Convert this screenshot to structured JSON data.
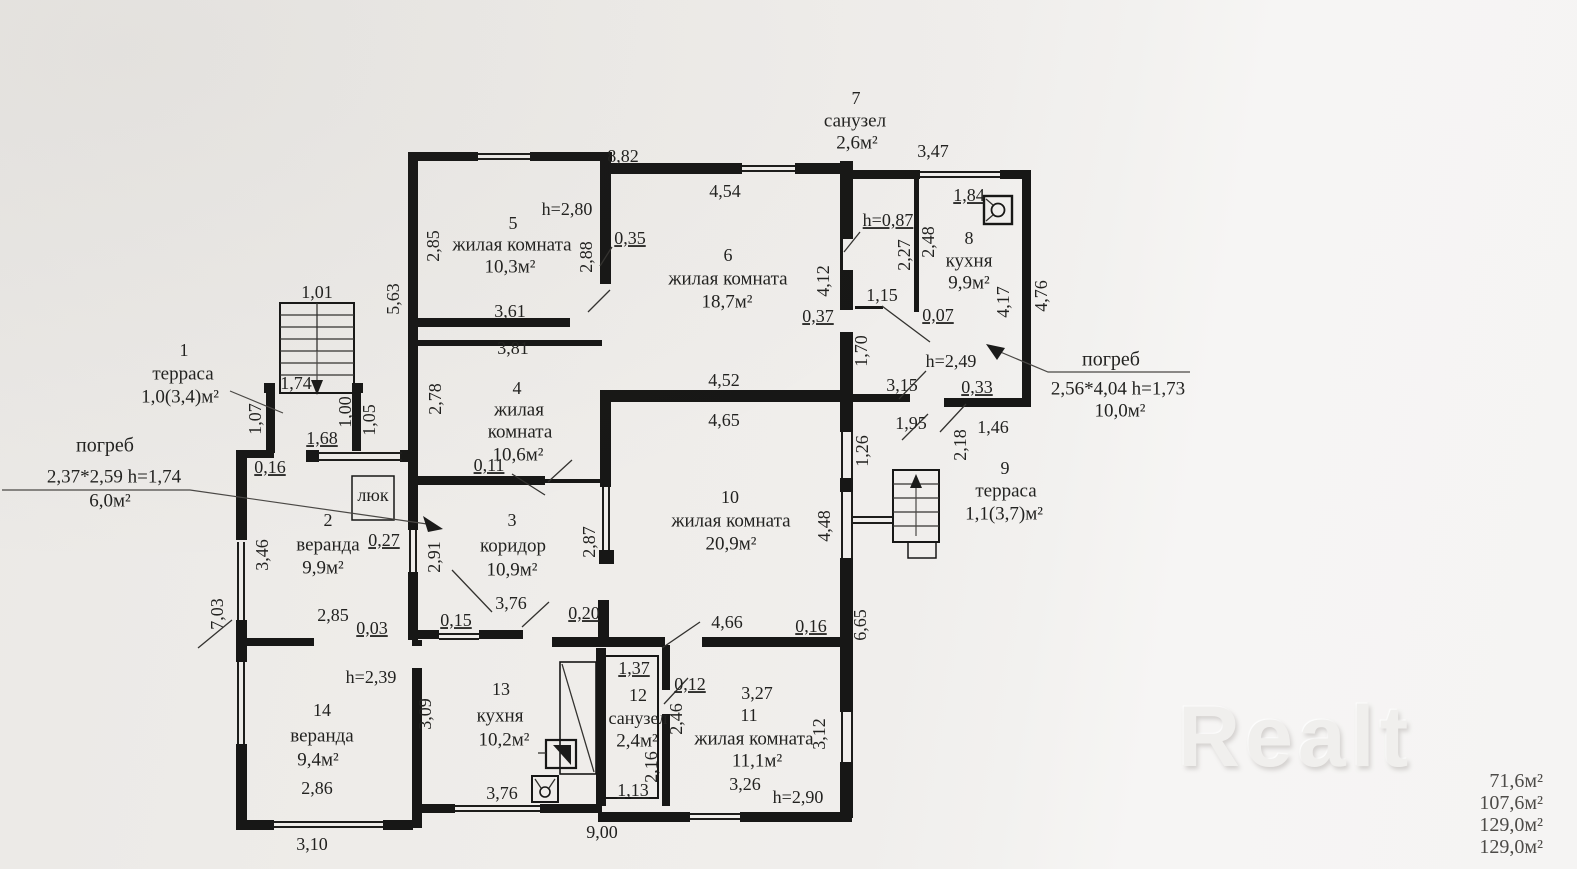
{
  "watermark": {
    "text": "Realt"
  },
  "totals": {
    "values": [
      "71,6м²",
      "107,6м²",
      "129,0м²",
      "129,0м²"
    ]
  },
  "rooms": [
    {
      "num": "1",
      "name": "терраса",
      "area": "1,0(3,4)м²"
    },
    {
      "num": "2",
      "name": "веранда",
      "area": "9,9м²"
    },
    {
      "num": "3",
      "name": "коридор",
      "area": "10,9м²"
    },
    {
      "num": "4",
      "name": "жилая комната",
      "area": "10,6м²"
    },
    {
      "num": "5",
      "name": "жилая комната",
      "area": "10,3м²",
      "ceiling": "h=2,80"
    },
    {
      "num": "6",
      "name": "жилая комната",
      "area": "18,7м²"
    },
    {
      "num": "7",
      "name": "санузел",
      "area": "2,6м²",
      "ceiling": "h=0,87"
    },
    {
      "num": "8",
      "name": "кухня",
      "area": "9,9м²"
    },
    {
      "num": "9",
      "name": "терраса",
      "area": "1,1(3,7)м²"
    },
    {
      "num": "10",
      "name": "жилая комната",
      "area": "20,9м²"
    },
    {
      "num": "11",
      "name": "жилая комната",
      "area": "11,1м²",
      "ceiling": "h=2,90"
    },
    {
      "num": "12",
      "name": "санузел",
      "area": "2,4м²"
    },
    {
      "num": "13",
      "name": "кухня",
      "area": "10,2м²"
    },
    {
      "num": "14",
      "name": "веранда",
      "area": "9,4м²",
      "ceiling": "h=2,39"
    }
  ],
  "cellars": [
    {
      "label": "погреб",
      "size": "2,37*2,59",
      "ceiling": "h=1,74",
      "area": "6,0м²"
    },
    {
      "label": "погреб",
      "size": "2,56*4,04",
      "ceiling": "h=1,73",
      "area": "10,0м²"
    }
  ],
  "hatch": {
    "label": "люк"
  },
  "plan": {
    "labels": [
      {
        "t": "8,82",
        "x": 623,
        "y": 158
      },
      {
        "t": "7",
        "x": 856,
        "y": 100,
        "n": "room-number"
      },
      {
        "t": "санузел",
        "x": 855,
        "y": 122,
        "s": 19,
        "n": "room-name"
      },
      {
        "t": "2,6м²",
        "x": 857,
        "y": 144,
        "s": 19,
        "n": "room-area"
      },
      {
        "t": "3,47",
        "x": 933,
        "y": 153
      },
      {
        "t": "4,54",
        "x": 725,
        "y": 193
      },
      {
        "t": "1,84",
        "x": 969,
        "y": 197,
        "u": true
      },
      {
        "t": "h=2,80",
        "x": 567,
        "y": 211,
        "n": "ceiling-height"
      },
      {
        "t": "5",
        "x": 513,
        "y": 225,
        "n": "room-number"
      },
      {
        "t": "h=0,87",
        "x": 888,
        "y": 222,
        "u": true,
        "n": "ceiling-height"
      },
      {
        "t": "жилая комната",
        "x": 512,
        "y": 246,
        "s": 19,
        "n": "room-name"
      },
      {
        "t": "10,3м²",
        "x": 510,
        "y": 268,
        "s": 19,
        "n": "room-area"
      },
      {
        "t": "2,85",
        "x": 435,
        "y": 246,
        "r": -90
      },
      {
        "t": "0,35",
        "x": 630,
        "y": 240,
        "u": true
      },
      {
        "t": "8",
        "x": 969,
        "y": 240,
        "n": "room-number"
      },
      {
        "t": "2,88",
        "x": 588,
        "y": 257,
        "r": -90
      },
      {
        "t": "6",
        "x": 728,
        "y": 257,
        "n": "room-number"
      },
      {
        "t": "2,27",
        "x": 906,
        "y": 255,
        "r": -90
      },
      {
        "t": "2,48",
        "x": 930,
        "y": 242,
        "r": -90
      },
      {
        "t": "кухня",
        "x": 969,
        "y": 262,
        "s": 19,
        "n": "room-name"
      },
      {
        "t": "жилая комната",
        "x": 728,
        "y": 280,
        "s": 19,
        "n": "room-name"
      },
      {
        "t": "9,9м²",
        "x": 969,
        "y": 284,
        "s": 19,
        "n": "room-area"
      },
      {
        "t": "4,12",
        "x": 825,
        "y": 281,
        "r": -90
      },
      {
        "t": "18,7м²",
        "x": 727,
        "y": 303,
        "s": 19,
        "n": "room-area"
      },
      {
        "t": "5,63",
        "x": 395,
        "y": 299,
        "r": -90
      },
      {
        "t": "1,01",
        "x": 317,
        "y": 294
      },
      {
        "t": "1,15",
        "x": 882,
        "y": 297
      },
      {
        "t": "4,17",
        "x": 1005,
        "y": 302,
        "r": -90
      },
      {
        "t": "4,76",
        "x": 1043,
        "y": 296,
        "r": -90
      },
      {
        "t": "3,61",
        "x": 510,
        "y": 313
      },
      {
        "t": "0,37",
        "x": 818,
        "y": 318,
        "u": true
      },
      {
        "t": "0,07",
        "x": 938,
        "y": 317,
        "u": true
      },
      {
        "t": "3,81",
        "x": 513,
        "y": 350
      },
      {
        "t": "1,70",
        "x": 863,
        "y": 351,
        "r": -90
      },
      {
        "t": "1",
        "x": 184,
        "y": 352,
        "n": "room-number"
      },
      {
        "t": "h=2,49",
        "x": 951,
        "y": 363,
        "n": "ceiling-height"
      },
      {
        "t": "погреб",
        "x": 1111,
        "y": 361,
        "s": 20,
        "n": "cellar-label"
      },
      {
        "t": "терраса",
        "x": 183,
        "y": 375,
        "s": 19,
        "n": "room-name"
      },
      {
        "t": "1,74",
        "x": 296,
        "y": 385
      },
      {
        "t": "4,52",
        "x": 724,
        "y": 382
      },
      {
        "t": "3,15",
        "x": 902,
        "y": 387
      },
      {
        "t": "0,33",
        "x": 977,
        "y": 389,
        "u": true
      },
      {
        "t": "2,56*4,04  h=1,73",
        "x": 1118,
        "y": 390,
        "s": 19,
        "n": "cellar-size"
      },
      {
        "t": "1,0(3,4)м²",
        "x": 180,
        "y": 398,
        "s": 19,
        "n": "room-area"
      },
      {
        "t": "4",
        "x": 517,
        "y": 390,
        "n": "room-number"
      },
      {
        "t": "2,78",
        "x": 437,
        "y": 399,
        "r": -90
      },
      {
        "t": "жилая",
        "x": 519,
        "y": 411,
        "s": 19,
        "n": "room-name"
      },
      {
        "t": "10,0м²",
        "x": 1120,
        "y": 412,
        "s": 19,
        "n": "cellar-area"
      },
      {
        "t": "1,07",
        "x": 257,
        "y": 419,
        "r": -90
      },
      {
        "t": "1,00",
        "x": 347,
        "y": 412,
        "r": -90
      },
      {
        "t": "1,05",
        "x": 371,
        "y": 420,
        "r": -90
      },
      {
        "t": "1,95",
        "x": 911,
        "y": 425
      },
      {
        "t": "4,65",
        "x": 724,
        "y": 422
      },
      {
        "t": "1,46",
        "x": 993,
        "y": 429
      },
      {
        "t": "комната",
        "x": 520,
        "y": 433,
        "s": 19,
        "n": "room-name"
      },
      {
        "t": "1,68",
        "x": 322,
        "y": 440,
        "u": true
      },
      {
        "t": "2,18",
        "x": 962,
        "y": 445,
        "r": -90
      },
      {
        "t": "погреб",
        "x": 105,
        "y": 447,
        "s": 20,
        "n": "cellar-label"
      },
      {
        "t": "1,26",
        "x": 864,
        "y": 451,
        "r": -90
      },
      {
        "t": "10,6м²",
        "x": 518,
        "y": 456,
        "s": 19,
        "n": "room-area"
      },
      {
        "t": "0,11",
        "x": 489,
        "y": 467,
        "u": true
      },
      {
        "t": "0,16",
        "x": 270,
        "y": 469,
        "u": true
      },
      {
        "t": "9",
        "x": 1005,
        "y": 470,
        "n": "room-number"
      },
      {
        "t": "2,37*2,59  h=1,74",
        "x": 114,
        "y": 478,
        "s": 19,
        "n": "cellar-size"
      },
      {
        "t": "терраса",
        "x": 1006,
        "y": 492,
        "s": 19,
        "n": "room-name"
      },
      {
        "t": "люк",
        "x": 373,
        "y": 497,
        "s": 18,
        "n": "hatch-label"
      },
      {
        "t": "6,0м²",
        "x": 110,
        "y": 502,
        "s": 19,
        "n": "cellar-area"
      },
      {
        "t": "1,1(3,7)м²",
        "x": 1004,
        "y": 515,
        "s": 19,
        "n": "room-area"
      },
      {
        "t": "2",
        "x": 328,
        "y": 522,
        "n": "room-number"
      },
      {
        "t": "3",
        "x": 512,
        "y": 522,
        "n": "room-number"
      },
      {
        "t": "10",
        "x": 730,
        "y": 499,
        "n": "room-number"
      },
      {
        "t": "жилая комната",
        "x": 731,
        "y": 522,
        "s": 19,
        "n": "room-name"
      },
      {
        "t": "20,9м²",
        "x": 731,
        "y": 545,
        "s": 19,
        "n": "room-area"
      },
      {
        "t": "0,27",
        "x": 384,
        "y": 542,
        "u": true
      },
      {
        "t": "веранда",
        "x": 328,
        "y": 546,
        "s": 19,
        "n": "room-name"
      },
      {
        "t": "коридор",
        "x": 513,
        "y": 547,
        "s": 19,
        "n": "room-name"
      },
      {
        "t": "2,87",
        "x": 591,
        "y": 542,
        "r": -90
      },
      {
        "t": "2,91",
        "x": 436,
        "y": 557,
        "r": -90
      },
      {
        "t": "4,48",
        "x": 826,
        "y": 526,
        "r": -90
      },
      {
        "t": "3,46",
        "x": 264,
        "y": 555,
        "r": -90
      },
      {
        "t": "9,9м²",
        "x": 323,
        "y": 569,
        "s": 19,
        "n": "room-area"
      },
      {
        "t": "10,9м²",
        "x": 512,
        "y": 571,
        "s": 19,
        "n": "room-area"
      },
      {
        "t": "3,76",
        "x": 511,
        "y": 605
      },
      {
        "t": "0,20",
        "x": 584,
        "y": 615,
        "u": true
      },
      {
        "t": "2,85",
        "x": 333,
        "y": 617
      },
      {
        "t": "7,03",
        "x": 219,
        "y": 614,
        "r": -90
      },
      {
        "t": "0,15",
        "x": 456,
        "y": 622,
        "u": true
      },
      {
        "t": "4,66",
        "x": 727,
        "y": 624
      },
      {
        "t": "0,16",
        "x": 811,
        "y": 628,
        "u": true
      },
      {
        "t": "6,65",
        "x": 862,
        "y": 625,
        "r": -90
      },
      {
        "t": "0,03",
        "x": 372,
        "y": 630,
        "u": true
      },
      {
        "t": "1,37",
        "x": 634,
        "y": 670,
        "u": true
      },
      {
        "t": "h=2,39",
        "x": 371,
        "y": 679,
        "n": "ceiling-height"
      },
      {
        "t": "0,12",
        "x": 690,
        "y": 686,
        "u": true
      },
      {
        "t": "13",
        "x": 501,
        "y": 691,
        "n": "room-number"
      },
      {
        "t": "3,27",
        "x": 757,
        "y": 695
      },
      {
        "t": "12",
        "x": 638,
        "y": 697,
        "n": "room-number"
      },
      {
        "t": "14",
        "x": 322,
        "y": 712,
        "n": "room-number"
      },
      {
        "t": "3,09",
        "x": 427,
        "y": 714,
        "r": -90
      },
      {
        "t": "кухня",
        "x": 500,
        "y": 717,
        "s": 19,
        "n": "room-name"
      },
      {
        "t": "11",
        "x": 749,
        "y": 717,
        "n": "room-number"
      },
      {
        "t": "санузел",
        "x": 638,
        "y": 720,
        "s": 18,
        "n": "room-name"
      },
      {
        "t": "2,46",
        "x": 678,
        "y": 719,
        "r": -90
      },
      {
        "t": "3,12",
        "x": 821,
        "y": 734,
        "r": -90
      },
      {
        "t": "веранда",
        "x": 322,
        "y": 737,
        "s": 19,
        "n": "room-name"
      },
      {
        "t": "жилая комната",
        "x": 754,
        "y": 740,
        "s": 19,
        "n": "room-name"
      },
      {
        "t": "10,2м²",
        "x": 504,
        "y": 741,
        "s": 19,
        "n": "room-area"
      },
      {
        "t": "2,4м²",
        "x": 637,
        "y": 742,
        "s": 19,
        "n": "room-area"
      },
      {
        "t": "9,4м²",
        "x": 318,
        "y": 761,
        "s": 19,
        "n": "room-area"
      },
      {
        "t": "11,1м²",
        "x": 757,
        "y": 762,
        "s": 19,
        "n": "room-area"
      },
      {
        "t": "2,16",
        "x": 653,
        "y": 767,
        "r": -90
      },
      {
        "t": "3,26",
        "x": 745,
        "y": 786
      },
      {
        "t": "2,86",
        "x": 317,
        "y": 790
      },
      {
        "t": "1,13",
        "x": 633,
        "y": 792,
        "u": true
      },
      {
        "t": "3,76",
        "x": 502,
        "y": 795
      },
      {
        "t": "h=2,90",
        "x": 798,
        "y": 799,
        "n": "ceiling-height"
      },
      {
        "t": "9,00",
        "x": 602,
        "y": 834
      },
      {
        "t": "3,10",
        "x": 312,
        "y": 846
      }
    ]
  }
}
